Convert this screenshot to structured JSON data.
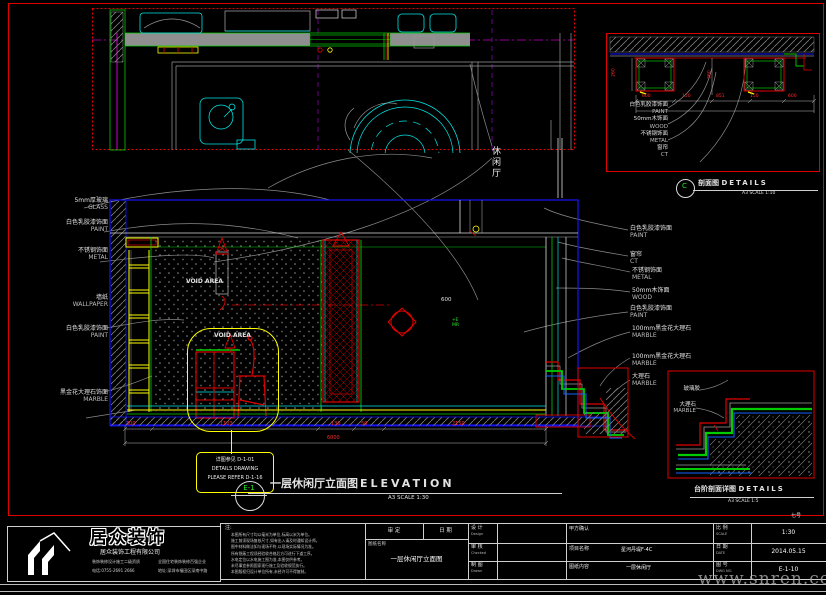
{
  "sheet": {
    "watermark": "www.snren.com",
    "sheet_tag": "七号"
  },
  "plan": {
    "room_label": "休闲厅"
  },
  "elevation": {
    "marker": "E-1",
    "title_cn": "一层休闲厅立面图",
    "title_en": "ELEVATION",
    "scale_text": "A3 SCALE 1:30",
    "void_area": "VOID AREA",
    "dim_600": "600",
    "tag_line1": "+E",
    "tag_line2": "MR",
    "note_box": [
      "详图参见 D-1-01",
      "DETAILS DRAWING",
      "PLEASE REFER D-1-16"
    ],
    "dims_bottom": {
      "segments": [
        "300",
        "1103",
        "130",
        "50",
        "2150"
      ],
      "total": "6000"
    },
    "left_labels": [
      {
        "cn": "5mm厚玻璃",
        "en": "GLASS"
      },
      {
        "cn": "白色乳胶漆饰面",
        "en": "PAINT"
      },
      {
        "cn": "不锈钢饰面",
        "en": "METAL"
      },
      {
        "cn": "墙纸",
        "en": "WALLPAPER"
      },
      {
        "cn": "白色乳胶漆饰面",
        "en": "PAINT"
      },
      {
        "cn": "黑金花大理石饰面",
        "en": "MARBLE"
      }
    ],
    "right_labels": [
      {
        "cn": "白色乳胶漆饰面",
        "en": "PAINT"
      },
      {
        "cn": "窗帘",
        "en": "CT"
      },
      {
        "cn": "不锈钢饰面",
        "en": "METAL"
      },
      {
        "cn": "50mm木饰面",
        "en": "WOOD"
      },
      {
        "cn": "白色乳胶漆饰面",
        "en": "PAINT"
      },
      {
        "cn": "100mm黑金花大理石",
        "en": "MARBLE"
      },
      {
        "cn": "100mm黑金花大理石",
        "en": "MARBLE"
      },
      {
        "cn": "大理石",
        "en": "MARBLE"
      }
    ]
  },
  "detail_top": {
    "marker": "C",
    "title_cn": "剖面图",
    "title_en": "DETAILS",
    "scale_text": "A3 SCALE 1:10",
    "labels": [
      {
        "cn": "白色乳胶漆饰面",
        "en": "PAINT"
      },
      {
        "cn": "50mm木饰面",
        "en": "WOOD"
      },
      {
        "cn": "不锈钢饰面",
        "en": "METAL"
      },
      {
        "cn": "窗帘",
        "en": "CT"
      }
    ],
    "dims_h": [
      "600",
      "150",
      "851",
      "150",
      "600"
    ],
    "dims_v": [
      "260",
      "360"
    ]
  },
  "detail_bottom": {
    "title_cn": "台阶剖面详图",
    "title_en": "DETAILS",
    "scale_text": "A3 SCALE 1:5",
    "label_glue": "玻璃胶",
    "label_marble_cn": "大理石",
    "label_marble_en": "MARBLE"
  },
  "titleblock": {
    "notes_title": "注:",
    "notes_lines": [
      "本图所有尺寸均以毫米为单位,标高以米为单位。",
      "施工前须现场复核尺寸,如有出入请及时通知设计师。",
      "图中材料做法如与现场不符,以现场实际情况为准。",
      "所有隐蔽工程须经验收合格后方可进行下道工序。",
      "水电定位以水电施工图为准,本图仅供参考。",
      "未尽事宜参照国家现行施工及验收规范执行。",
      "本图版权归设计单位所有,未经许可不得复制。"
    ],
    "approve_label": "审 定",
    "date_label": "日 期",
    "sheet_name_label": "图纸名称",
    "sheet_name_value": "一层休闲厅立面图",
    "design_label": "设 计",
    "design_en": "Design",
    "check_label": "审 核",
    "check_en": "Checked",
    "draw_label": "制 图",
    "draw_en": "Drawn",
    "client_confirm_label": "甲方确认",
    "project_label": "项目名称",
    "project_value": "星河丹堤F-4C",
    "content_label": "图纸内容",
    "content_value": "一层休闲厅",
    "scale_label": "比 例",
    "scale_en": "SCALE",
    "scale_value": "1:30",
    "date2_label": "日 期",
    "date_en": "DATE",
    "date_value": "2014.05.15",
    "dwg_label": "图 号",
    "dwg_en": "DWG NO.",
    "dwg_value": "E-1-10"
  },
  "logo": {
    "brand": "居众装饰",
    "company": "居众装饰工程有限公司",
    "left_line1": "装饰装修设计施工二级资质",
    "left_line2": "电话:0755-2691 2666",
    "right_line1": "全国住宅装饰装修百强企业",
    "right_line2": "地址:深圳市福田区深南中路"
  }
}
